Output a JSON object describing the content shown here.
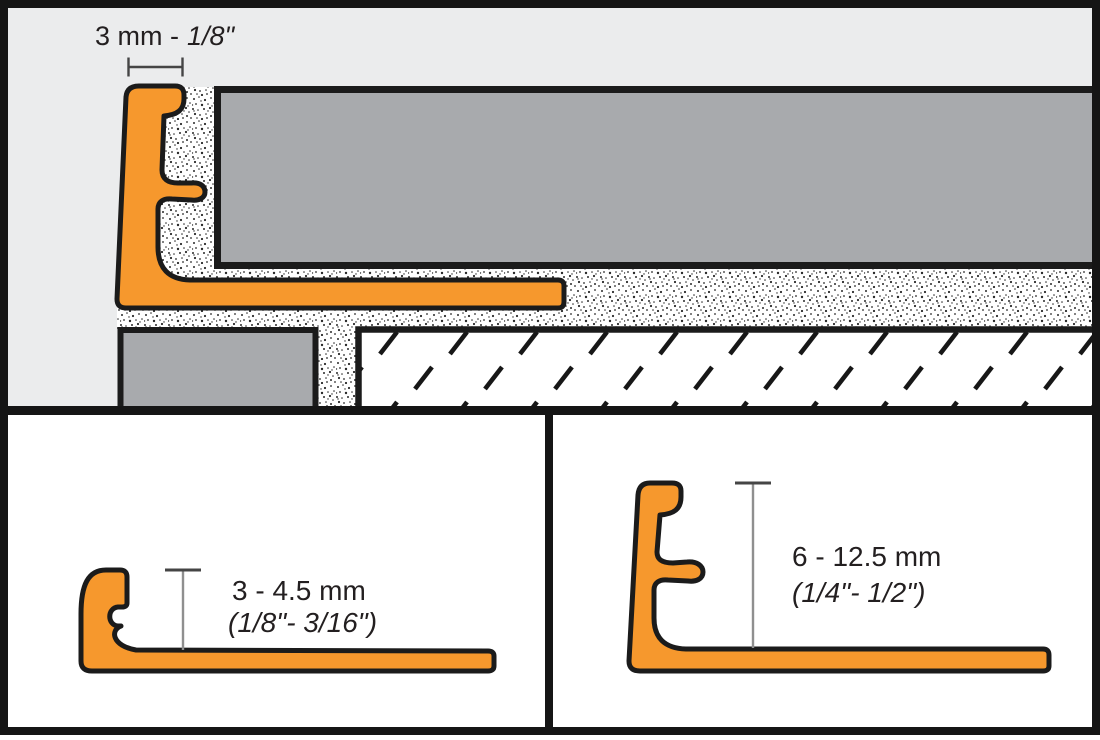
{
  "diagram": {
    "title_semantic": "tile-edge-profile-installation-cross-section",
    "top_panel": {
      "dimension_label": {
        "metric": "3 mm -",
        "imperial": "1/8\""
      }
    },
    "bottom_left_panel": {
      "size_metric": "3 - 4.5 mm",
      "size_imperial": "(1/8\"- 3/16\")"
    },
    "bottom_right_panel": {
      "size_metric": "6 - 12.5 mm",
      "size_imperial": "(1/4\"- 1/2\")"
    }
  },
  "colors": {
    "profile": "#F6982D",
    "tile": "#A8AAAD",
    "panel": "#EBECED",
    "outline": "#1B1B1B",
    "white": "#FFFFFF",
    "dim_line": "#8F8F8F",
    "dim_tick": "#454545",
    "text": "#231F20",
    "frame": "#151515"
  }
}
